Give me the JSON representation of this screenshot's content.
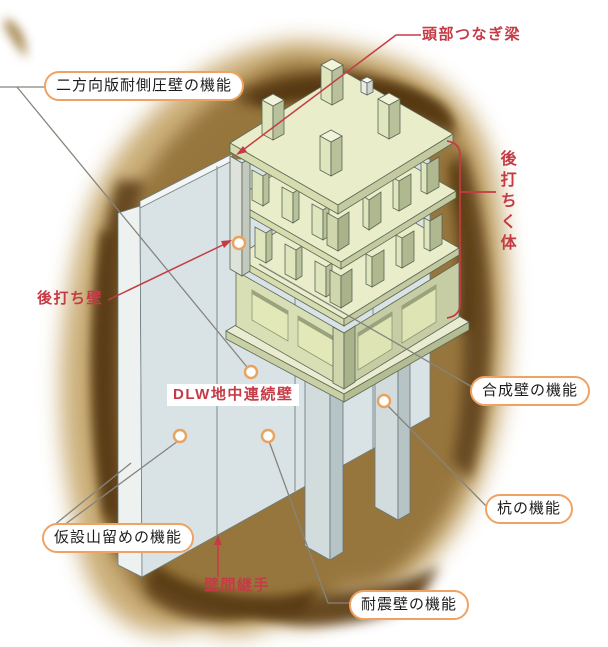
{
  "diagram": {
    "type": "isometric construction cutaway of DLW diaphragm wall with post-cast basement structure and piles",
    "labels": {
      "top_beam": "頭部つなぎ梁",
      "two_way_wall": "二方向版耐側圧壁の機能",
      "post_cast_body": "後打ちく体",
      "post_cast_wall": "後打ち壁",
      "dlw_wall": "DLW地中連続壁",
      "composite_wall": "合成壁の機能",
      "pile": "杭の機能",
      "temp_retaining": "仮設山留めの機能",
      "wall_joint": "壁間継手",
      "seismic_wall": "耐震壁の機能"
    },
    "marker_style": "white-circle-with-orange-ring",
    "colors": {
      "accent_red": "#c53b45",
      "pill_border": "#f0a263",
      "marker_ring": "#eaa25f",
      "soil_brown": "#97763e",
      "soil_dark": "#53360f",
      "wall_blue_gray": "#d9e3e5",
      "slab_green": "#eaedca",
      "column_olive": "#b9c19a",
      "background": "#ffffff"
    }
  }
}
